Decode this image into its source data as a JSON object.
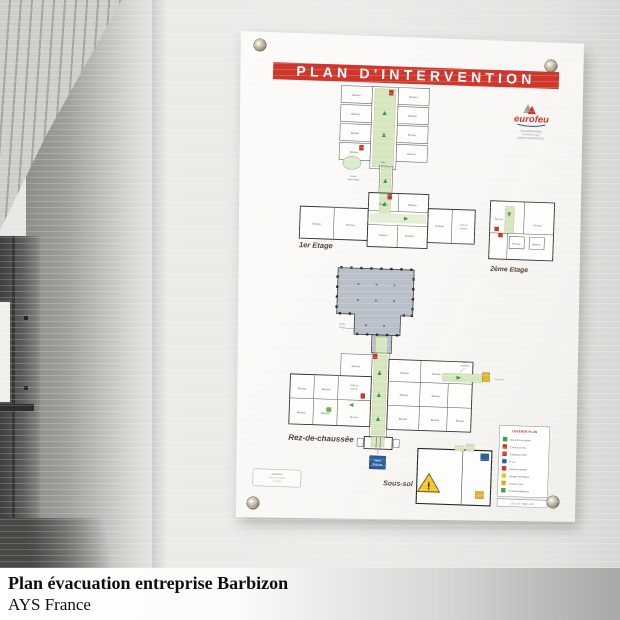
{
  "caption": {
    "line1": "Plan évacuation entreprise Barbizon",
    "line2": "AYS France"
  },
  "panel": {
    "title": "PLAN D'INTERVENTION",
    "logo": {
      "brand": "eurofeu",
      "address_lines": [
        "Rue Albert Rémy",
        "ZA de la Loge",
        "28250 SENONCHES"
      ]
    },
    "floor_labels": {
      "first": "1er Etage",
      "second": "2ème Etage",
      "ground": "Rez-de-chaussée",
      "basement": "Sous-sol"
    },
    "room_labels": {
      "office": "Bureau",
      "meeting_l1": "Salle de",
      "meeting_l2": "réunion",
      "break_l1": "Salle",
      "break_l2": "de pause",
      "access_stage_l1": "Accès",
      "access_stage_l2": "Etage",
      "access_second_l1": "Accès",
      "access_second_l2": "2ème Etage",
      "boiler_l1": "Accès",
      "boiler_l2": "chaufferie",
      "meter": "Compteur"
    },
    "you_are_here": {
      "l1": "VOUS",
      "l2": "ÊTES ICI"
    },
    "cartouche": {
      "l1": "EUROFEU",
      "l2": "Plan d'intervention",
      "l3": "N° 7288"
    },
    "legend": {
      "title": "LEGENDE PLAN",
      "ref": "13 11 07 7288 - 001",
      "items": [
        {
          "label": "Sens d'évacuation",
          "color": "#3aa24a"
        },
        {
          "label": "Extincteur eau",
          "color": "#cf372c"
        },
        {
          "label": "Extincteur CO2",
          "color": "#cf372c"
        },
        {
          "label": "R.I.A.",
          "color": "#2b5fa0"
        },
        {
          "label": "Alarme incendie",
          "color": "#cf372c"
        },
        {
          "label": "Danger spécifique",
          "color": "#f0c22e"
        },
        {
          "label": "Coupure gaz",
          "color": "#d8a81f"
        },
        {
          "label": "Pt rassemblement",
          "color": "#3aa24a"
        }
      ]
    }
  },
  "colors": {
    "banner_red": "#cf372c",
    "corridor_green": "#d8e6c0",
    "roof_gray": "#b9c0c9",
    "sign_blue": "#2b5fa0",
    "warning_yellow": "#f6c62f",
    "arrow_green": "#2e9e3f"
  }
}
